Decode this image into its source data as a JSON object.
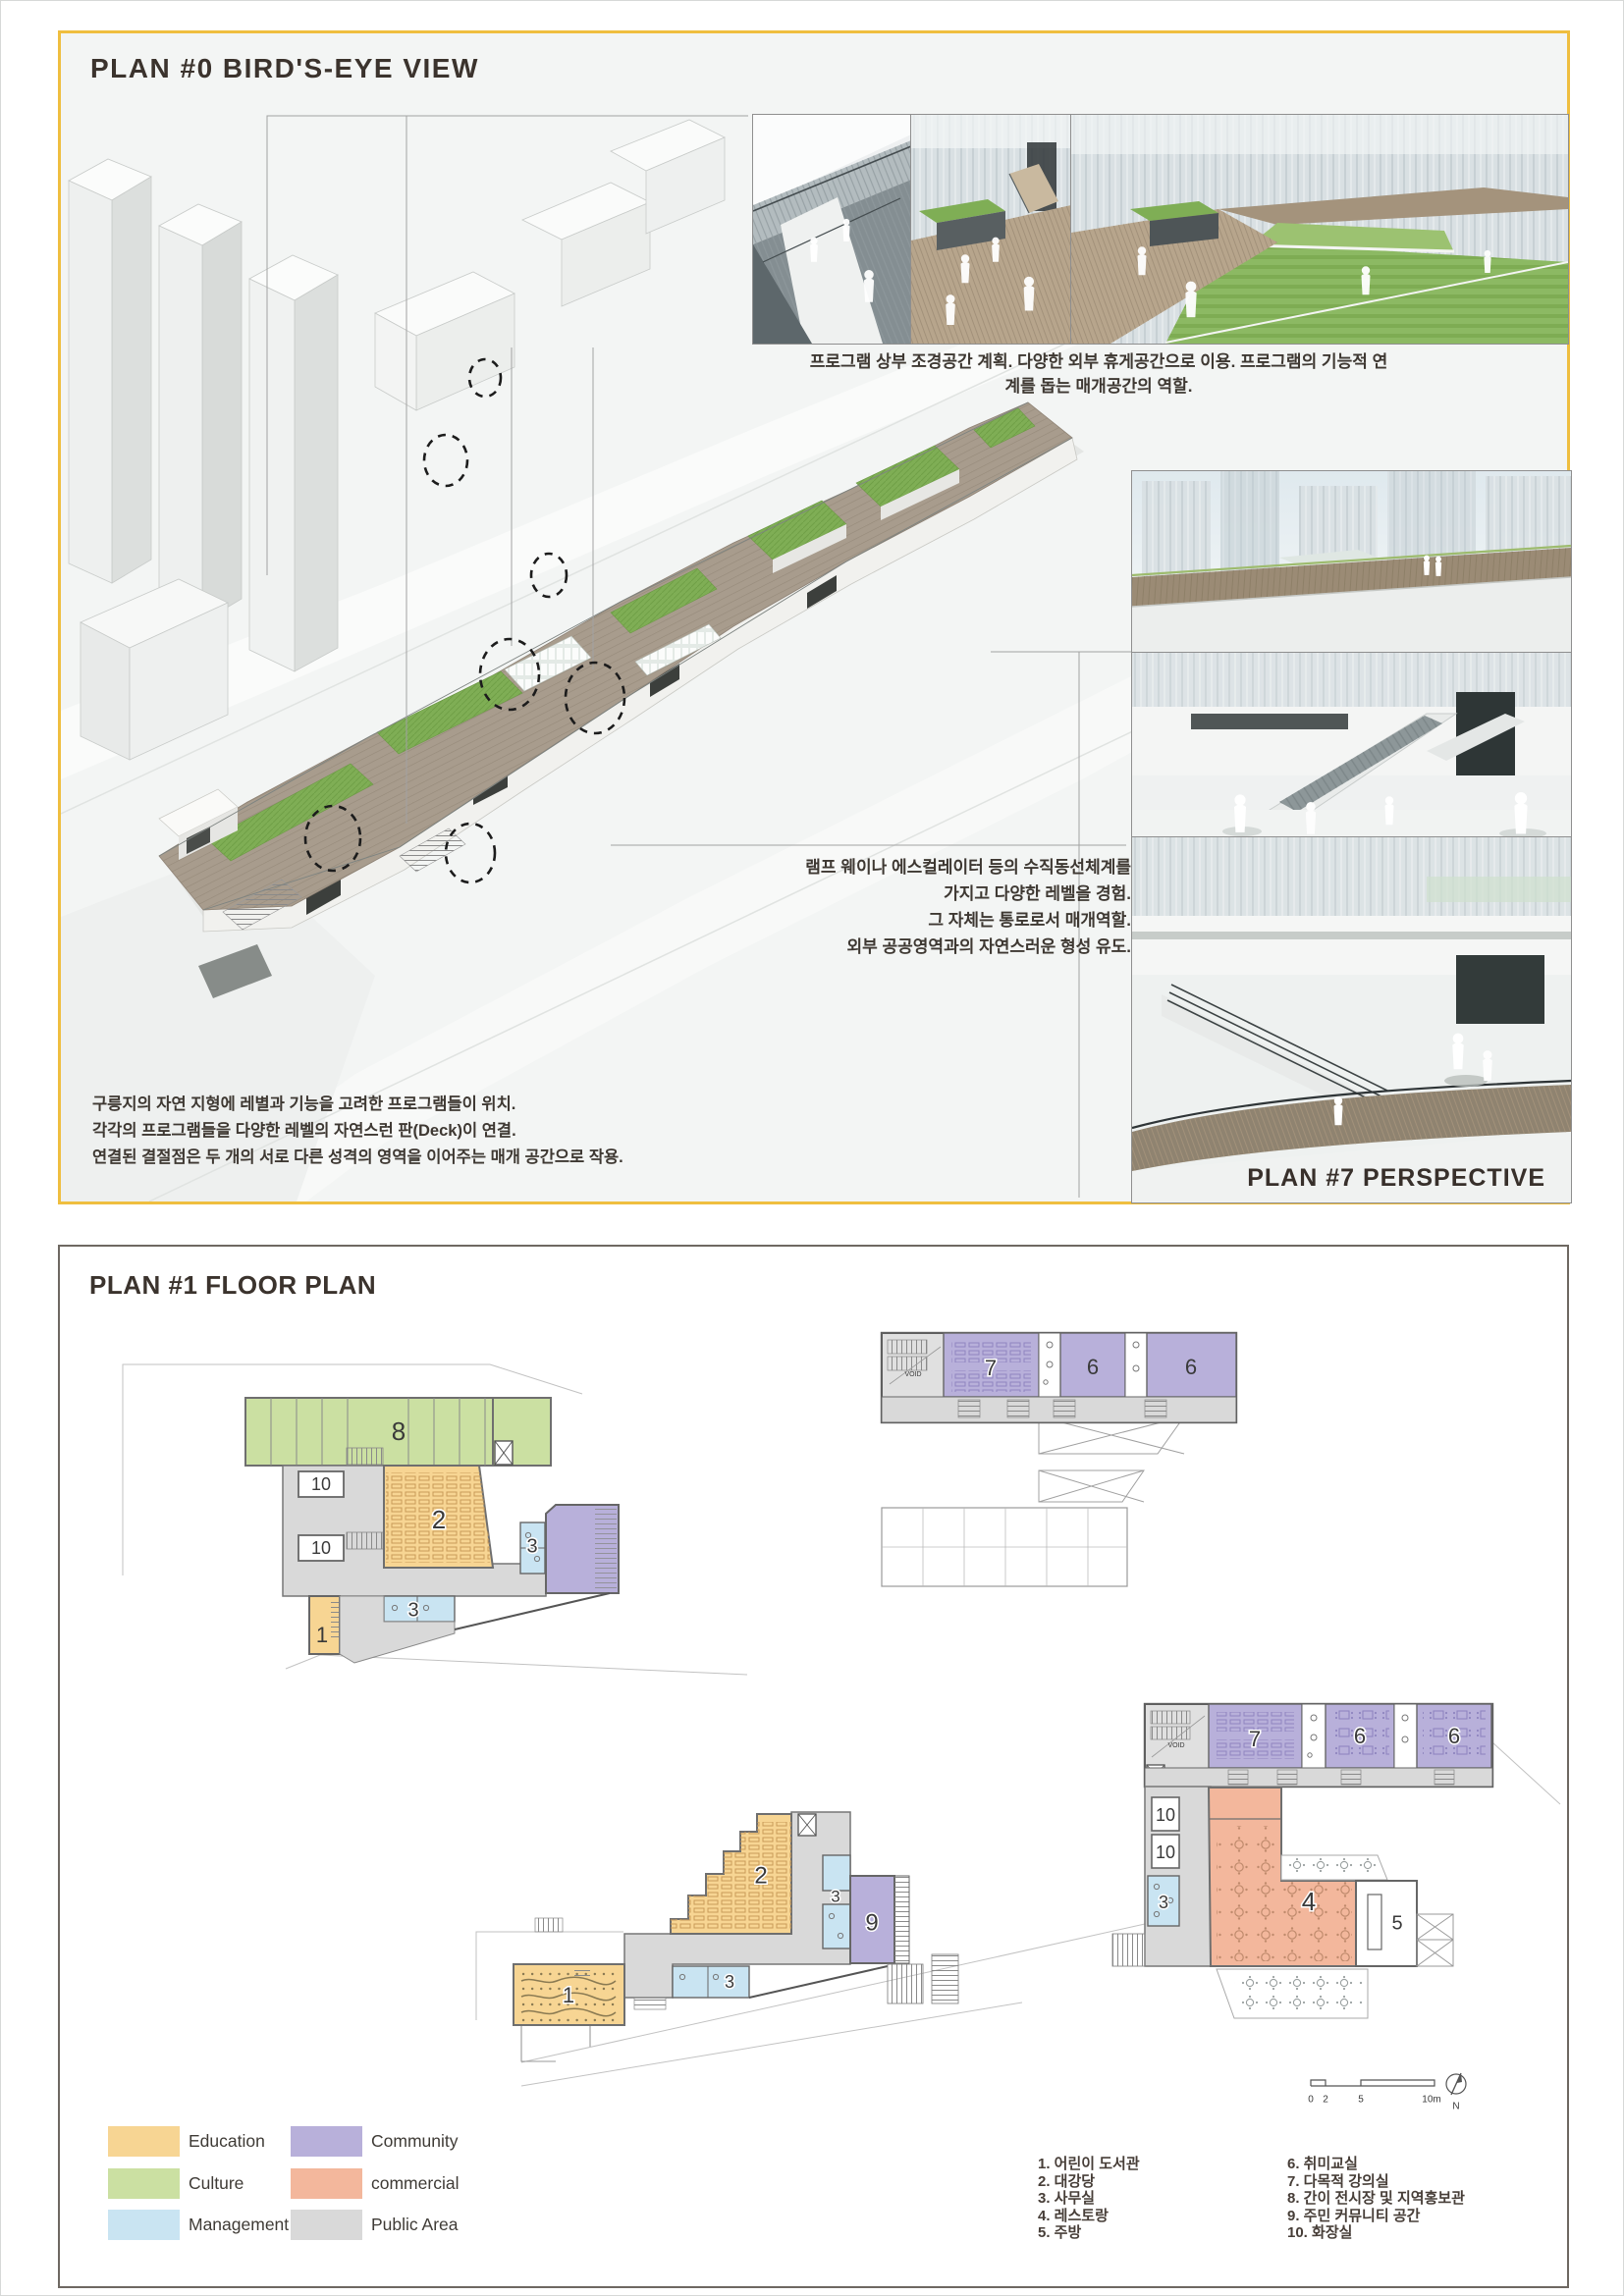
{
  "colors": {
    "accent": "#EFBE3F",
    "panel2_border": "#6E6862",
    "ink": "#3B332D",
    "edu": "#F7D593",
    "cul": "#CBE0A2",
    "mgmt": "#C9E4F2",
    "comm": "#B8B0DA",
    "commercial": "#F3B79C",
    "public": "#D9D9D9",
    "wood": "#A79B8C",
    "grass": "#7FAE55"
  },
  "panel1": {
    "title": "PLAN #0 BIRD'S-EYE VIEW",
    "caption_top": "프로그램 상부 조경공간 계획. 다양한 외부 휴게공간으로 이용. 프로그램의 기능적 연계를 돕는 매개공간의 역할.",
    "annotation_right": {
      "line1": "램프 웨이나 에스컬레이터 등의 수직동선체계를",
      "line2": "가지고 다양한 레벨을 경험.",
      "line3": "그 자체는 통로로서 매개역할.",
      "line4": "외부 공공영역과의 자연스러운 형성 유도."
    },
    "annotation_left": {
      "line1": "구릉지의 자연 지형에 레별과 기능을 고려한 프로그램들이 위치.",
      "line2": "각각의 프로그램들을 다양한 레벨의 자연스런 판(Deck)이 연결.",
      "line3": "연결된 결절점은 두 개의 서로 다른 성격의 영역을 이어주는 매개 공간으로 작용."
    },
    "perspective_label": "PLAN #7 PERSPECTIVE"
  },
  "panel2": {
    "title": "PLAN #1 FLOOR PLAN",
    "legend": [
      {
        "label": "Education"
      },
      {
        "label": "Culture"
      },
      {
        "label": "Management"
      },
      {
        "label": "Community"
      },
      {
        "label": "commercial"
      },
      {
        "label": "Public Area"
      }
    ],
    "rooms_left": [
      "1. 어린이 도서관",
      "2. 대강당",
      "3. 사무실",
      "4. 레스토랑",
      "5. 주방"
    ],
    "rooms_right": [
      "6. 취미교실",
      "7. 다목적 강의실",
      "8. 간이 전시장 및 지역홍보관",
      "9. 주민 커뮤니티 공간",
      "10. 화장실"
    ],
    "plan_labels": {
      "a8": "8",
      "a10a": "10",
      "a10b": "10",
      "a2": "2",
      "a3a": "3",
      "a3b": "3",
      "a1": "1",
      "b7": "7",
      "b6a": "6",
      "b6b": "6",
      "b_void": "VOID",
      "c2": "2",
      "c3a": "3",
      "c3b": "3",
      "c9": "9",
      "c1": "1",
      "d7": "7",
      "d6a": "6",
      "d6b": "6",
      "d_void": "VOID",
      "d10a": "10",
      "d10b": "10",
      "d3": "3",
      "d4": "4",
      "d5": "5"
    },
    "scale_bar": {
      "t0": "0",
      "t2": "2",
      "t5": "5",
      "t10": "10m",
      "north": "N"
    }
  }
}
